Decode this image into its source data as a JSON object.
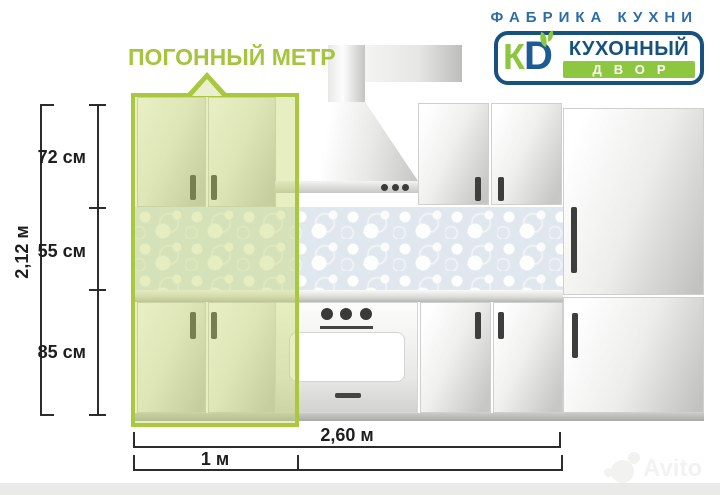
{
  "brand": {
    "tagline": "ФАБРИКА КУХНИ",
    "monogram_k": "К",
    "monogram_d": "D",
    "name_top": "КУХОННЫЙ",
    "name_bottom": "ДВОР",
    "blue": "#1c5c94",
    "green": "#8dc63f"
  },
  "callout": {
    "label": "ПОГОННЫЙ МЕТР",
    "highlight_color": "#a9c83e"
  },
  "dimensions": {
    "total_height": "2,12 м",
    "height_segments": [
      {
        "label": "72 см"
      },
      {
        "label": "55 см"
      },
      {
        "label": "85 см"
      }
    ],
    "total_width": "2,60 м",
    "linear_meter": "1 м"
  },
  "watermark": {
    "text": "Avito"
  }
}
